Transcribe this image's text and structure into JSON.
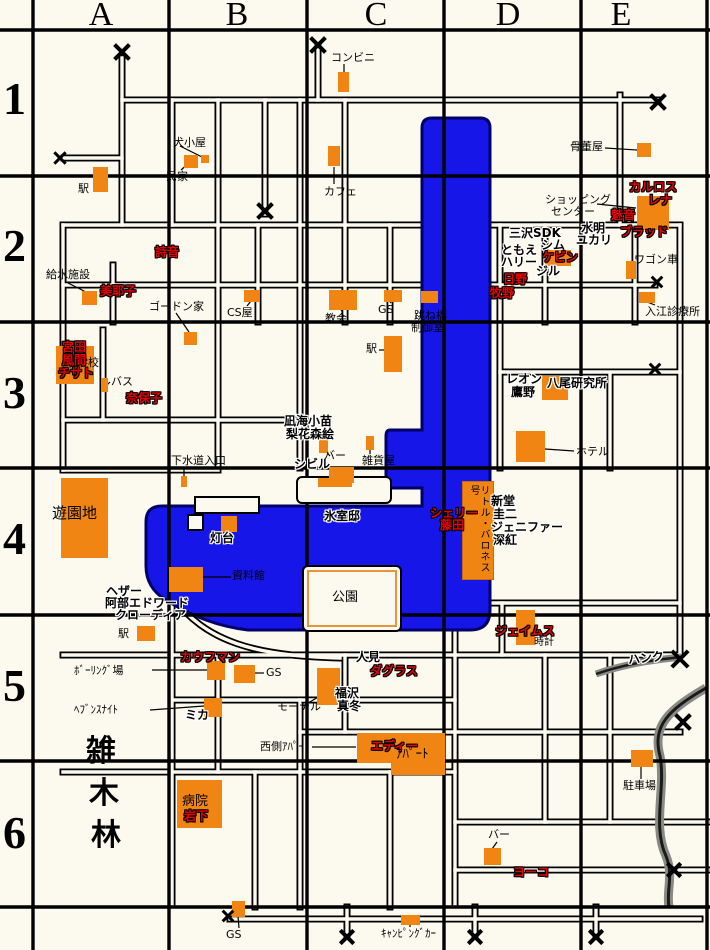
{
  "grid": {
    "columns": [
      {
        "label": "A",
        "cx": 101
      },
      {
        "label": "B",
        "cx": 237
      },
      {
        "label": "C",
        "cx": 376
      },
      {
        "label": "D",
        "cx": 508
      },
      {
        "label": "E",
        "cx": 621
      }
    ],
    "rows": [
      {
        "label": "1",
        "y": 76
      },
      {
        "label": "2",
        "y": 223
      },
      {
        "label": "3",
        "y": 370
      },
      {
        "label": "4",
        "y": 516
      },
      {
        "label": "5",
        "y": 663
      },
      {
        "label": "6",
        "y": 810
      }
    ]
  },
  "colors": {
    "background": "#FCFAEE",
    "building": "#F08514",
    "water": "#1616E8",
    "water_border": "#000066",
    "character_red": "#E80000",
    "text": "#000000"
  },
  "buildings": [
    {
      "name": "convenience-store",
      "x": 338,
      "y": 72,
      "w": 11,
      "h": 20
    },
    {
      "name": "station-a1",
      "x": 93,
      "y": 167,
      "w": 15,
      "h": 25
    },
    {
      "name": "private-house",
      "x": 184,
      "y": 155,
      "w": 14,
      "h": 13
    },
    {
      "name": "dog-house",
      "x": 201,
      "y": 155,
      "w": 8,
      "h": 8
    },
    {
      "name": "cafe",
      "x": 328,
      "y": 146,
      "w": 12,
      "h": 20
    },
    {
      "name": "antique-shop",
      "x": 637,
      "y": 143,
      "w": 14,
      "h": 14
    },
    {
      "name": "shopping-center",
      "x": 637,
      "y": 196,
      "w": 32,
      "h": 34
    },
    {
      "name": "kevin-building",
      "x": 545,
      "y": 250,
      "w": 26,
      "h": 16
    },
    {
      "name": "wagon",
      "x": 626,
      "y": 261,
      "w": 10,
      "h": 18
    },
    {
      "name": "irie-clinic",
      "x": 639,
      "y": 292,
      "w": 16,
      "h": 11
    },
    {
      "name": "drawbridge-control",
      "x": 421,
      "y": 291,
      "w": 17,
      "h": 12
    },
    {
      "name": "water-facility",
      "x": 82,
      "y": 291,
      "w": 15,
      "h": 14
    },
    {
      "name": "gordon-house",
      "x": 184,
      "y": 332,
      "w": 13,
      "h": 13
    },
    {
      "name": "cs-shop",
      "x": 244,
      "y": 290,
      "w": 16,
      "h": 12
    },
    {
      "name": "church",
      "x": 329,
      "y": 290,
      "w": 28,
      "h": 20
    },
    {
      "name": "gas-station-c2",
      "x": 384,
      "y": 290,
      "w": 18,
      "h": 12
    },
    {
      "name": "station-c3",
      "x": 384,
      "y": 336,
      "w": 18,
      "h": 36
    },
    {
      "name": "school",
      "x": 56,
      "y": 346,
      "w": 38,
      "h": 38
    },
    {
      "name": "bus-stop",
      "x": 101,
      "y": 378,
      "w": 7,
      "h": 14
    },
    {
      "name": "sewer-entrance",
      "x": 181,
      "y": 476,
      "w": 6,
      "h": 11
    },
    {
      "name": "bar-c4",
      "x": 319,
      "y": 438,
      "w": 9,
      "h": 15
    },
    {
      "name": "sybil-building",
      "x": 329,
      "y": 467,
      "w": 25,
      "h": 16
    },
    {
      "name": "general-store",
      "x": 366,
      "y": 436,
      "w": 8,
      "h": 14
    },
    {
      "name": "yao-laboratory",
      "x": 542,
      "y": 376,
      "w": 26,
      "h": 24
    },
    {
      "name": "hotel",
      "x": 516,
      "y": 431,
      "w": 29,
      "h": 31
    },
    {
      "name": "amusement-park",
      "x": 61,
      "y": 478,
      "w": 47,
      "h": 80
    },
    {
      "name": "lighthouse",
      "x": 221,
      "y": 516,
      "w": 16,
      "h": 16
    },
    {
      "name": "museum",
      "x": 169,
      "y": 567,
      "w": 34,
      "h": 25
    },
    {
      "name": "himuro-mansion",
      "x": 318,
      "y": 478,
      "w": 34,
      "h": 9
    },
    {
      "name": "james-building",
      "x": 516,
      "y": 610,
      "w": 19,
      "h": 35
    },
    {
      "name": "station-a5",
      "x": 137,
      "y": 626,
      "w": 18,
      "h": 15
    },
    {
      "name": "bowling-alley",
      "x": 207,
      "y": 661,
      "w": 18,
      "h": 19
    },
    {
      "name": "gas-station-b5",
      "x": 234,
      "y": 665,
      "w": 21,
      "h": 18
    },
    {
      "name": "heavens-night",
      "x": 204,
      "y": 698,
      "w": 18,
      "h": 19
    },
    {
      "name": "motel",
      "x": 317,
      "y": 668,
      "w": 23,
      "h": 37
    },
    {
      "name": "apartment-west",
      "x": 357,
      "y": 733,
      "w": 36,
      "h": 30
    },
    {
      "name": "apartment-east",
      "x": 391,
      "y": 733,
      "w": 54,
      "h": 42
    },
    {
      "name": "hospital",
      "x": 177,
      "y": 780,
      "w": 45,
      "h": 48
    },
    {
      "name": "bar-d6",
      "x": 484,
      "y": 848,
      "w": 17,
      "h": 17
    },
    {
      "name": "parking-lot",
      "x": 631,
      "y": 750,
      "w": 22,
      "h": 17
    },
    {
      "name": "gas-station-s",
      "x": 232,
      "y": 901,
      "w": 13,
      "h": 16
    },
    {
      "name": "camper-van",
      "x": 401,
      "y": 915,
      "w": 19,
      "h": 10
    }
  ],
  "boat": {
    "name": "little-baroness",
    "label": "リトル・バロネス号",
    "x": 462,
    "y": 481,
    "w": 30,
    "h": 97
  },
  "islands": [
    {
      "name": "himuro-island",
      "x": 296,
      "y": 476,
      "w": 92,
      "h": 24,
      "park": false
    },
    {
      "name": "park-island",
      "x": 302,
      "y": 565,
      "w": 96,
      "h": 63,
      "park": true
    }
  ],
  "docks": [
    {
      "x": 194,
      "y": 496,
      "w": 62,
      "h": 14
    },
    {
      "x": 187,
      "y": 514,
      "w": 13,
      "h": 13
    }
  ],
  "labels": [
    {
      "t": "コンビニ",
      "x": 331,
      "y": 52,
      "s": "plain",
      "k": "place"
    },
    {
      "t": "犬小屋",
      "x": 173,
      "y": 137,
      "s": "plain",
      "k": "place"
    },
    {
      "t": "民家",
      "x": 166,
      "y": 171,
      "s": "plain",
      "k": "place"
    },
    {
      "t": "駅",
      "x": 78,
      "y": 183,
      "s": "plain",
      "k": "place"
    },
    {
      "t": "カフェ",
      "x": 324,
      "y": 186,
      "s": "plain",
      "k": "place"
    },
    {
      "t": "骨董屋",
      "x": 570,
      "y": 141,
      "s": "plain",
      "k": "place"
    },
    {
      "t": "ショッピング",
      "x": 545,
      "y": 194,
      "s": "plain",
      "k": "place"
    },
    {
      "t": "センター",
      "x": 551,
      "y": 206,
      "s": "plain",
      "k": "place"
    },
    {
      "t": "カルロス",
      "x": 629,
      "y": 181,
      "s": "red",
      "k": "character"
    },
    {
      "t": "レナ",
      "x": 648,
      "y": 194,
      "s": "red",
      "k": "character"
    },
    {
      "t": "魅音",
      "x": 611,
      "y": 209,
      "s": "red",
      "k": "character"
    },
    {
      "t": "水明",
      "x": 581,
      "y": 222,
      "s": "outline",
      "k": "character"
    },
    {
      "t": "ユカリ",
      "x": 576,
      "y": 234,
      "s": "outline",
      "k": "character"
    },
    {
      "t": "ブラッド",
      "x": 620,
      "y": 226,
      "s": "red",
      "k": "character"
    },
    {
      "t": "三沢SDK",
      "x": 509,
      "y": 227,
      "s": "outline",
      "k": "character"
    },
    {
      "t": "シム",
      "x": 541,
      "y": 239,
      "s": "outline",
      "k": "character"
    },
    {
      "t": "ともえ",
      "x": 501,
      "y": 244,
      "s": "outline",
      "k": "character"
    },
    {
      "t": "ハリー",
      "x": 501,
      "y": 256,
      "s": "outline",
      "k": "character"
    },
    {
      "t": "ケビン",
      "x": 542,
      "y": 251,
      "s": "red",
      "k": "character"
    },
    {
      "t": "ジル",
      "x": 536,
      "y": 265,
      "s": "outline",
      "k": "character"
    },
    {
      "t": "日野",
      "x": 503,
      "y": 273,
      "s": "red",
      "k": "character"
    },
    {
      "t": "牧野",
      "x": 490,
      "y": 287,
      "s": "red",
      "k": "character"
    },
    {
      "t": "ワゴン車",
      "x": 634,
      "y": 254,
      "s": "plain",
      "k": "place"
    },
    {
      "t": "入江診療所",
      "x": 645,
      "y": 306,
      "s": "plain",
      "k": "place"
    },
    {
      "t": "跳ね橋",
      "x": 414,
      "y": 310,
      "s": "plain",
      "k": "place"
    },
    {
      "t": "制御室",
      "x": 411,
      "y": 322,
      "s": "plain",
      "k": "place"
    },
    {
      "t": "給水施設",
      "x": 46,
      "y": 269,
      "s": "plain",
      "k": "place"
    },
    {
      "t": "詩音",
      "x": 155,
      "y": 246,
      "s": "red",
      "k": "character"
    },
    {
      "t": "美耶子",
      "x": 100,
      "y": 285,
      "s": "red",
      "k": "character"
    },
    {
      "t": "ゴードン家",
      "x": 149,
      "y": 301,
      "s": "plain",
      "k": "place"
    },
    {
      "t": "CS屋",
      "x": 227,
      "y": 307,
      "s": "plain",
      "k": "place"
    },
    {
      "t": "教会",
      "x": 325,
      "y": 313,
      "s": "plain",
      "k": "place"
    },
    {
      "t": "GS",
      "x": 378,
      "y": 304,
      "s": "plain",
      "k": "place"
    },
    {
      "t": "駅",
      "x": 366,
      "y": 343,
      "s": "plain",
      "k": "place"
    },
    {
      "t": "小学校",
      "x": 66,
      "y": 357,
      "s": "plain",
      "k": "place"
    },
    {
      "t": "宮田",
      "x": 62,
      "y": 341,
      "s": "red",
      "k": "character"
    },
    {
      "t": "風間",
      "x": 62,
      "y": 354,
      "s": "red",
      "k": "character"
    },
    {
      "t": "チサト",
      "x": 58,
      "y": 367,
      "s": "red",
      "k": "character"
    },
    {
      "t": "バス",
      "x": 111,
      "y": 376,
      "s": "plain",
      "k": "place"
    },
    {
      "t": "奈保子",
      "x": 126,
      "y": 392,
      "s": "red",
      "k": "character"
    },
    {
      "t": "レオン",
      "x": 506,
      "y": 373,
      "s": "outline",
      "k": "character"
    },
    {
      "t": "鷹野",
      "x": 511,
      "y": 386,
      "s": "outline",
      "k": "character"
    },
    {
      "t": "八尾研究所",
      "x": 547,
      "y": 377,
      "s": "outline",
      "k": "place"
    },
    {
      "t": "ホテル",
      "x": 576,
      "y": 446,
      "s": "plain",
      "k": "place"
    },
    {
      "t": "下水道入口",
      "x": 171,
      "y": 455,
      "s": "plain",
      "k": "place"
    },
    {
      "t": "凪海小苗",
      "x": 284,
      "y": 415,
      "s": "outline",
      "k": "character"
    },
    {
      "t": "梨花森絵",
      "x": 286,
      "y": 428,
      "s": "outline",
      "k": "character"
    },
    {
      "t": "シビル",
      "x": 294,
      "y": 458,
      "s": "outline",
      "k": "character"
    },
    {
      "t": "バー",
      "x": 324,
      "y": 450,
      "s": "plain",
      "k": "place"
    },
    {
      "t": "雑貨屋",
      "x": 362,
      "y": 455,
      "s": "plain",
      "k": "place"
    },
    {
      "t": "遊園地",
      "x": 52,
      "y": 506,
      "s": "plain",
      "k": "place",
      "size": 15
    },
    {
      "t": "灯台",
      "x": 210,
      "y": 532,
      "s": "outline",
      "k": "place"
    },
    {
      "t": "氷室邸",
      "x": 324,
      "y": 510,
      "s": "outline",
      "k": "place"
    },
    {
      "t": "資料館",
      "x": 232,
      "y": 570,
      "s": "plain",
      "k": "place"
    },
    {
      "t": "公園",
      "x": 332,
      "y": 591,
      "s": "plain",
      "k": "place",
      "size": 13
    },
    {
      "t": "シェリー",
      "x": 430,
      "y": 507,
      "s": "red",
      "k": "character"
    },
    {
      "t": "藤田",
      "x": 440,
      "y": 519,
      "s": "red",
      "k": "character"
    },
    {
      "t": "新堂",
      "x": 491,
      "y": 495,
      "s": "outline",
      "k": "character"
    },
    {
      "t": "圭二",
      "x": 493,
      "y": 508,
      "s": "outline",
      "k": "character"
    },
    {
      "t": "ジェニファー",
      "x": 491,
      "y": 521,
      "s": "outline",
      "k": "character"
    },
    {
      "t": "深紅",
      "x": 493,
      "y": 534,
      "s": "outline",
      "k": "character"
    },
    {
      "t": "ヘザー",
      "x": 106,
      "y": 585,
      "s": "outline",
      "k": "character"
    },
    {
      "t": "阿部エドワード",
      "x": 105,
      "y": 597,
      "s": "outline",
      "k": "character"
    },
    {
      "t": "クローディア",
      "x": 115,
      "y": 609,
      "s": "outline",
      "k": "character"
    },
    {
      "t": "駅",
      "x": 118,
      "y": 628,
      "s": "plain",
      "k": "place"
    },
    {
      "t": "ジェイムス",
      "x": 495,
      "y": 625,
      "s": "red",
      "k": "character"
    },
    {
      "t": "時計",
      "x": 534,
      "y": 638,
      "s": "plain",
      "k": "place",
      "size": 10
    },
    {
      "t": "ハンク",
      "x": 628,
      "y": 652,
      "s": "outline",
      "k": "character",
      "rot": -6
    },
    {
      "t": "ﾎﾞｰﾘﾝｸﾞ場",
      "x": 74,
      "y": 665,
      "s": "plain",
      "k": "place"
    },
    {
      "t": "カウフマン",
      "x": 180,
      "y": 651,
      "s": "red",
      "k": "character"
    },
    {
      "t": "GS",
      "x": 266,
      "y": 667,
      "s": "plain",
      "k": "place"
    },
    {
      "t": "人見",
      "x": 356,
      "y": 651,
      "s": "outline",
      "k": "character"
    },
    {
      "t": "ダグラス",
      "x": 370,
      "y": 665,
      "s": "red",
      "k": "character"
    },
    {
      "t": "ﾍﾌﾞﾝｽﾅｲﾄ",
      "x": 74,
      "y": 704,
      "s": "plain",
      "k": "place"
    },
    {
      "t": "ミカ",
      "x": 185,
      "y": 709,
      "s": "outline",
      "k": "character"
    },
    {
      "t": "福沢",
      "x": 335,
      "y": 687,
      "s": "outline",
      "k": "character"
    },
    {
      "t": "真冬",
      "x": 337,
      "y": 700,
      "s": "outline",
      "k": "character"
    },
    {
      "t": "モーテル",
      "x": 277,
      "y": 701,
      "s": "plain",
      "k": "place"
    },
    {
      "t": "西側ｱﾊﾟｰﾄ",
      "x": 260,
      "y": 741,
      "s": "plain",
      "k": "place"
    },
    {
      "t": "エディー",
      "x": 371,
      "y": 740,
      "s": "red",
      "k": "character"
    },
    {
      "t": "ｱﾊﾟｰﾄ",
      "x": 396,
      "y": 748,
      "s": "plain",
      "k": "place",
      "size": 13
    },
    {
      "t": "雑",
      "x": 86,
      "y": 736,
      "s": "big",
      "k": "place"
    },
    {
      "t": "木",
      "x": 89,
      "y": 778,
      "s": "big",
      "k": "place"
    },
    {
      "t": "林",
      "x": 91,
      "y": 820,
      "s": "big",
      "k": "place"
    },
    {
      "t": "病院",
      "x": 182,
      "y": 795,
      "s": "plain",
      "k": "place",
      "size": 13
    },
    {
      "t": "岩下",
      "x": 184,
      "y": 810,
      "s": "red",
      "k": "character"
    },
    {
      "t": "バー",
      "x": 488,
      "y": 829,
      "s": "plain",
      "k": "place"
    },
    {
      "t": "ヨーコ",
      "x": 513,
      "y": 866,
      "s": "red",
      "k": "character"
    },
    {
      "t": "駐車場",
      "x": 623,
      "y": 780,
      "s": "plain",
      "k": "place"
    },
    {
      "t": "GS",
      "x": 226,
      "y": 929,
      "s": "plain",
      "k": "place"
    },
    {
      "t": "ｷｬﾝﾋﾟﾝｸﾞｶｰ",
      "x": 381,
      "y": 928,
      "s": "plain",
      "k": "place"
    }
  ],
  "x_marks": [
    {
      "x": 122,
      "y": 52,
      "size": 18
    },
    {
      "x": 318,
      "y": 45,
      "size": 18
    },
    {
      "x": 60,
      "y": 158,
      "size": 13
    },
    {
      "x": 265,
      "y": 211,
      "size": 18
    },
    {
      "x": 658,
      "y": 102,
      "size": 18
    },
    {
      "x": 657,
      "y": 282,
      "size": 12
    },
    {
      "x": 655,
      "y": 369,
      "size": 12
    },
    {
      "x": 680,
      "y": 659,
      "size": 20
    },
    {
      "x": 683,
      "y": 722,
      "size": 18
    },
    {
      "x": 674,
      "y": 870,
      "size": 16
    },
    {
      "x": 228,
      "y": 916,
      "size": 12
    },
    {
      "x": 347,
      "y": 937,
      "size": 16
    },
    {
      "x": 475,
      "y": 937,
      "size": 16
    },
    {
      "x": 596,
      "y": 937,
      "size": 16
    }
  ]
}
